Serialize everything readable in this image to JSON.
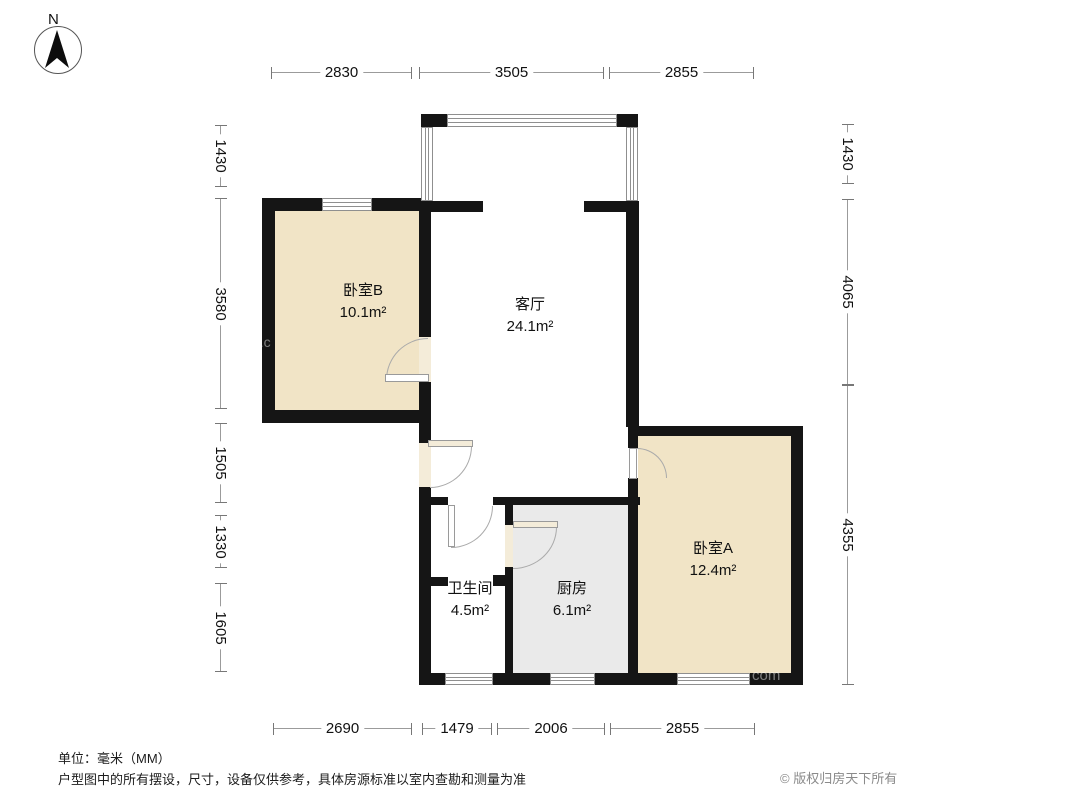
{
  "compass": {
    "label": "N"
  },
  "rooms": {
    "bedroom_b": {
      "name": "卧室B",
      "area": "10.1m²"
    },
    "living": {
      "name": "客厅",
      "area": "24.1m²"
    },
    "bedroom_a": {
      "name": "卧室A",
      "area": "12.4m²"
    },
    "bathroom": {
      "name": "卫生间",
      "area": "4.5m²"
    },
    "kitchen": {
      "name": "厨房",
      "area": "6.1m²"
    }
  },
  "dimensions_mm": {
    "top": [
      "2830",
      "3505",
      "2855"
    ],
    "bottom": [
      "2690",
      "1479",
      "2006",
      "2855"
    ],
    "left": [
      "1430",
      "3580",
      "1505",
      "1330",
      "1605"
    ],
    "right": [
      "1430",
      "4065",
      "4355"
    ]
  },
  "footer": {
    "unit_note": "单位：毫米（MM）",
    "disclaimer": "户型图中的所有摆设，尺寸，设备仅供参考，具体房源标准以室内查勘和测量为准",
    "copyright": "© 版权归房天下所有"
  },
  "watermark": {
    "fragment_left": "g.c",
    "fragment_right": "com"
  },
  "colors": {
    "wall": "#151515",
    "bedroom_fill": "#f1e4c6",
    "kitchen_fill": "#eaeaea",
    "door_fill": "#f4ecd9",
    "dim_line": "#999999"
  }
}
